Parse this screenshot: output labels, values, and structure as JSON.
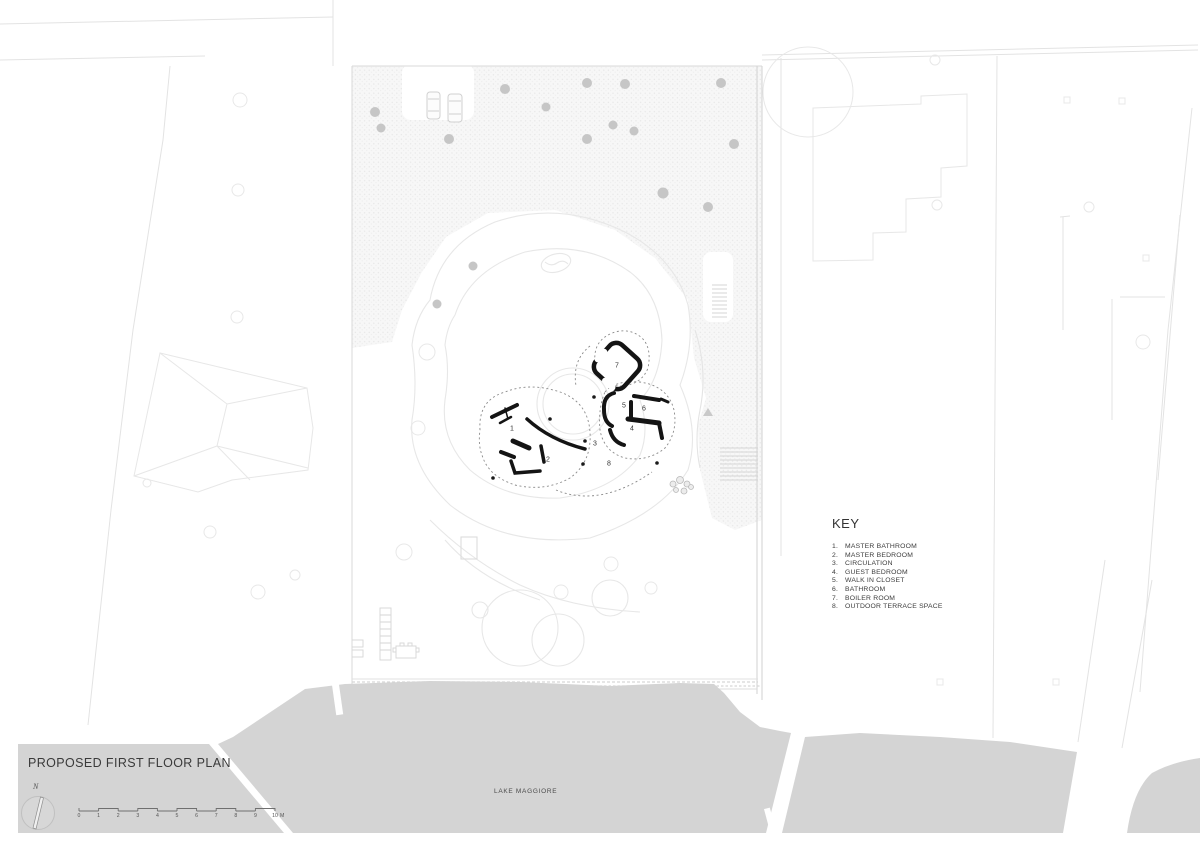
{
  "title": "PROPOSED FIRST FLOOR PLAN",
  "key": {
    "heading": "KEY",
    "items": [
      {
        "num": "1.",
        "label": "MASTER BATHROOM"
      },
      {
        "num": "2.",
        "label": "MASTER BEDROOM"
      },
      {
        "num": "3.",
        "label": "CIRCULATION"
      },
      {
        "num": "4.",
        "label": "GUEST BEDROOM"
      },
      {
        "num": "5.",
        "label": "WALK IN CLOSET"
      },
      {
        "num": "6.",
        "label": "BATHROOM"
      },
      {
        "num": "7.",
        "label": "BOILER ROOM"
      },
      {
        "num": "8.",
        "label": "OUTDOOR TERRACE SPACE"
      }
    ]
  },
  "lake_label": "LAKE MAGGIORE",
  "north_label": "N",
  "scale_bar": {
    "labels": [
      "0",
      "1",
      "2",
      "3",
      "4",
      "5",
      "6",
      "7",
      "8",
      "9",
      "10"
    ],
    "unit": "M"
  },
  "plan_markers": [
    "1",
    "2",
    "3",
    "4",
    "5",
    "6",
    "7",
    "8"
  ],
  "colors": {
    "lake": "#d4d4d4",
    "walls": "#141414",
    "tree_dot": "#c6c6c6",
    "faint_line": "#e7e7e7"
  }
}
